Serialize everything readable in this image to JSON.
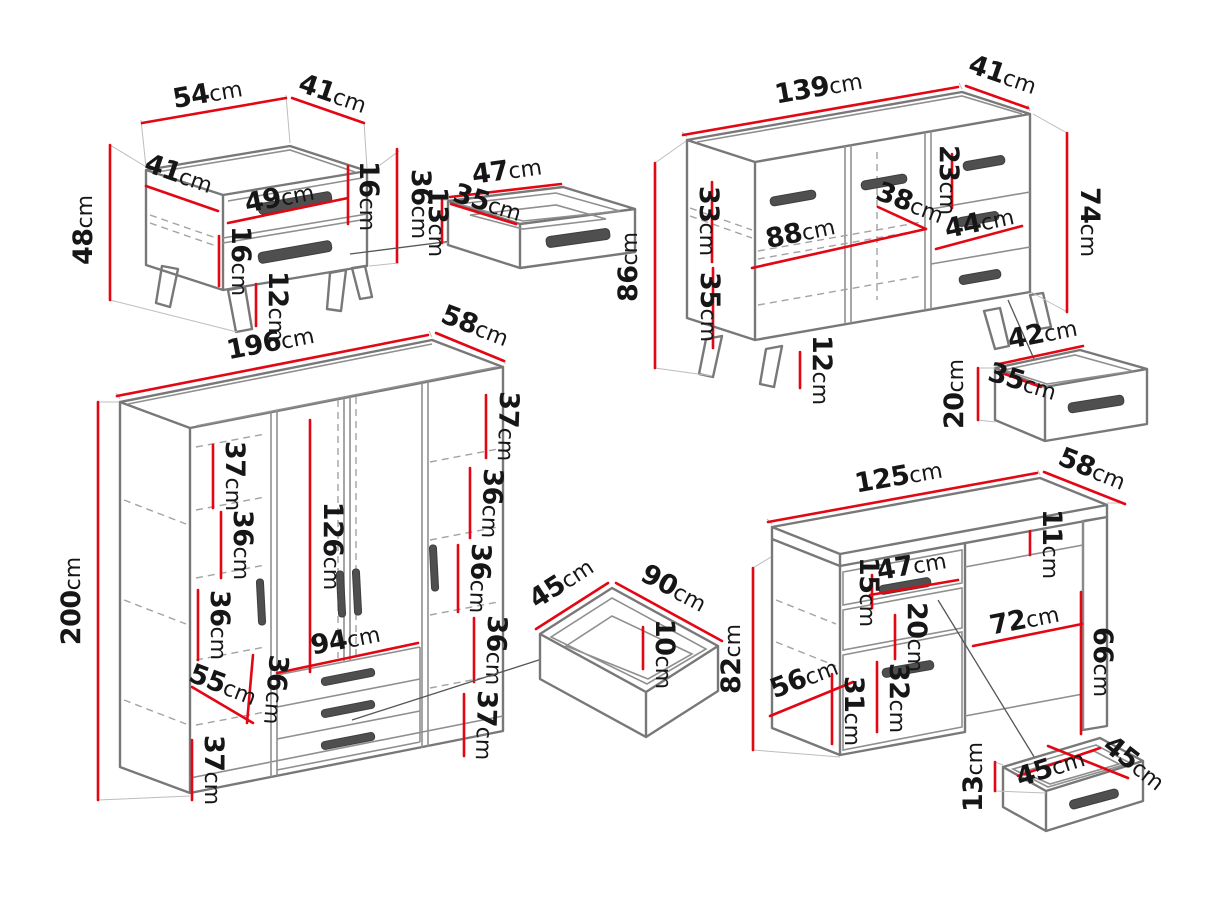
{
  "unit": "cm",
  "colors": {
    "dimension_red": "#e30613",
    "outline_gray": "#787878",
    "handle_gray": "#4f4f4f",
    "text": "#161616",
    "background": "#ffffff"
  },
  "pieces": {
    "nightstand": {
      "top_width": "54",
      "top_depth": "41",
      "height": "48",
      "inner_depth": "41",
      "drawer_width": "49",
      "top_drawer_height": "16",
      "front_height": "36",
      "bottom_drawer_height": "16",
      "leg_height": "12"
    },
    "drawer_a": {
      "width": "47",
      "depth": "35",
      "height": "13"
    },
    "sideboard": {
      "top_width": "139",
      "top_depth": "41",
      "height_left": "86",
      "upper_inner_height": "33",
      "lower_inner_height": "35",
      "inner_width": "88",
      "shelf_depth": "38",
      "top_drawer_height": "23",
      "drawer_width": "44",
      "height_right": "74",
      "leg_height": "12"
    },
    "drawer_b": {
      "width": "42",
      "depth": "35",
      "height": "20"
    },
    "wardrobe": {
      "top_width": "196",
      "top_depth": "58",
      "height": "200",
      "left_section_1": "37",
      "left_section_2": "36",
      "left_section_3": "36",
      "left_shelf_width": "55",
      "left_section_4": "37",
      "door_height": "126",
      "drawer_width": "94",
      "drawer_section_height": "36",
      "right_section_1": "37",
      "right_section_2": "36",
      "right_section_3": "36",
      "right_section_4": "36",
      "right_section_5": "37"
    },
    "drawer_c": {
      "depth": "45",
      "width": "90",
      "height": "10"
    },
    "desk": {
      "top_width": "125",
      "top_depth": "58",
      "height": "82",
      "drawer_width": "47",
      "drawer_height": "15",
      "niche_height": "20",
      "apron_height": "11",
      "kneehole_width": "72",
      "kneehole_height": "66",
      "side_depth": "56",
      "lower_side_height": "31",
      "door_height": "32"
    },
    "drawer_d": {
      "height": "13",
      "width": "45",
      "depth": "45"
    }
  }
}
